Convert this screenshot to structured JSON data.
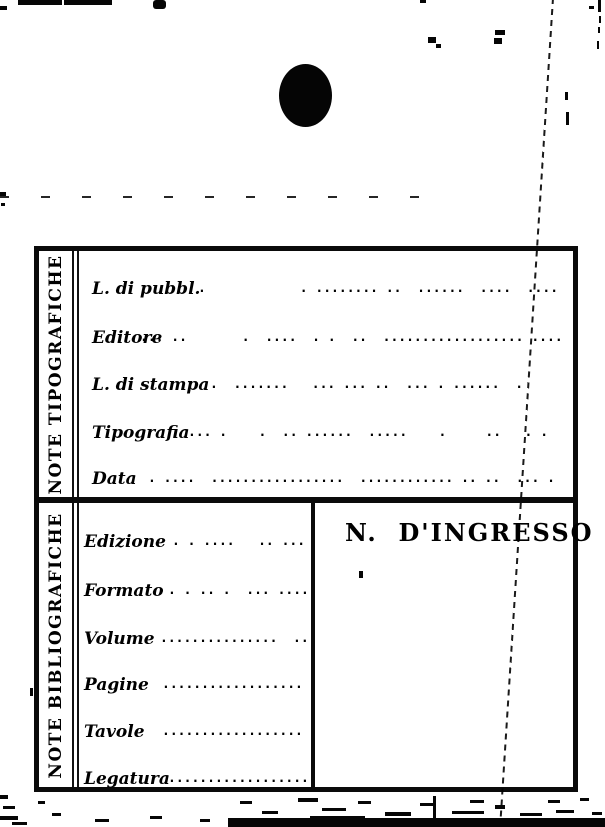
{
  "card": {
    "typographic_section": {
      "side_label": "NOTE TIPOGRAFICHE",
      "fields": [
        {
          "label": "L. di pubbl.",
          "dots": ".            . ........ ..  ......  ....  ....",
          "value": ""
        },
        {
          "label": "Editore",
          "dots": "... ..       .  ....  . .  ..  .................. ....",
          "value": ""
        },
        {
          "label": "L. di stampa",
          "dots": ".  .......   ... ... ..  ... . ......  .",
          "value": ""
        },
        {
          "label": "Tipografia",
          "dots": "... .    .  .. ......  .....    .     ..   . .",
          "value": ""
        },
        {
          "label": "Data",
          "dots": ". ....  .................  ............ .. ..  ... .",
          "value": ""
        }
      ]
    },
    "bibliographic_section": {
      "side_label": "NOTE BIBLIOGRAFICHE",
      "fields": [
        {
          "label": "Edizione",
          "dots": ". . ....   .. ...",
          "value": ""
        },
        {
          "label": "Formato",
          "dots": ". . .. .  ... ....",
          "value": ""
        },
        {
          "label": "Volume",
          "dots": "...............  ..",
          "value": ""
        },
        {
          "label": "Pagine",
          "dots": "..................",
          "value": ""
        },
        {
          "label": "Tavole",
          "dots": "..................",
          "value": ""
        },
        {
          "label": "Legatura",
          "dots": "..................",
          "value": ""
        }
      ],
      "accession_cell": {
        "label": "N.  D'INGRESSO",
        "value": ""
      }
    },
    "colors": {
      "ink": "#0a0a0a",
      "paper": "#ffffff"
    }
  }
}
